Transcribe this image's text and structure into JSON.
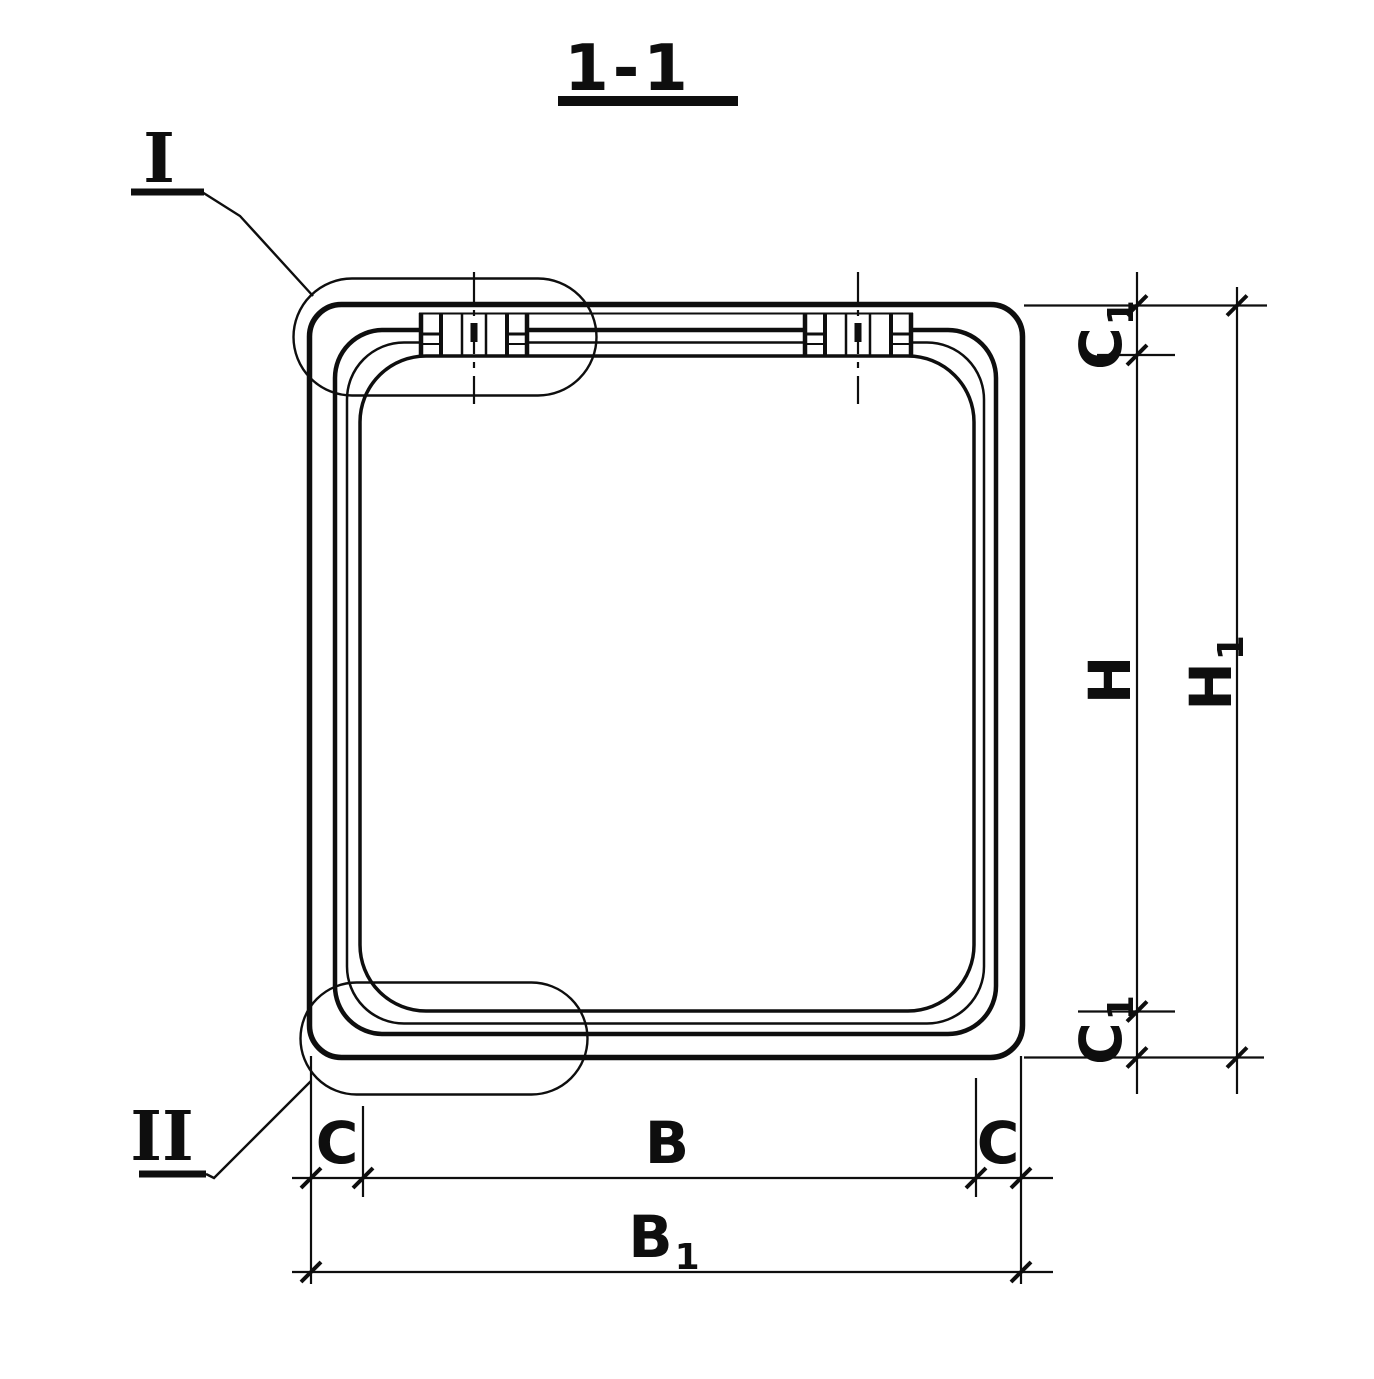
{
  "title": "1-1",
  "markers": {
    "detail_one": "I",
    "detail_two": "II"
  },
  "dimensions": {
    "c1_top": {
      "label": "C",
      "sub": "1"
    },
    "h": {
      "label": "H",
      "sub": ""
    },
    "h1": {
      "label": "H",
      "sub": "1"
    },
    "c1_bottom": {
      "label": "C",
      "sub": "1"
    },
    "c_left": {
      "label": "C",
      "sub": ""
    },
    "b": {
      "label": "B",
      "sub": ""
    },
    "c_right": {
      "label": "C",
      "sub": ""
    },
    "b1": {
      "label": "B",
      "sub": "1"
    }
  },
  "colors": {
    "ink": "#0e0e0e",
    "paper": "#ffffff"
  }
}
